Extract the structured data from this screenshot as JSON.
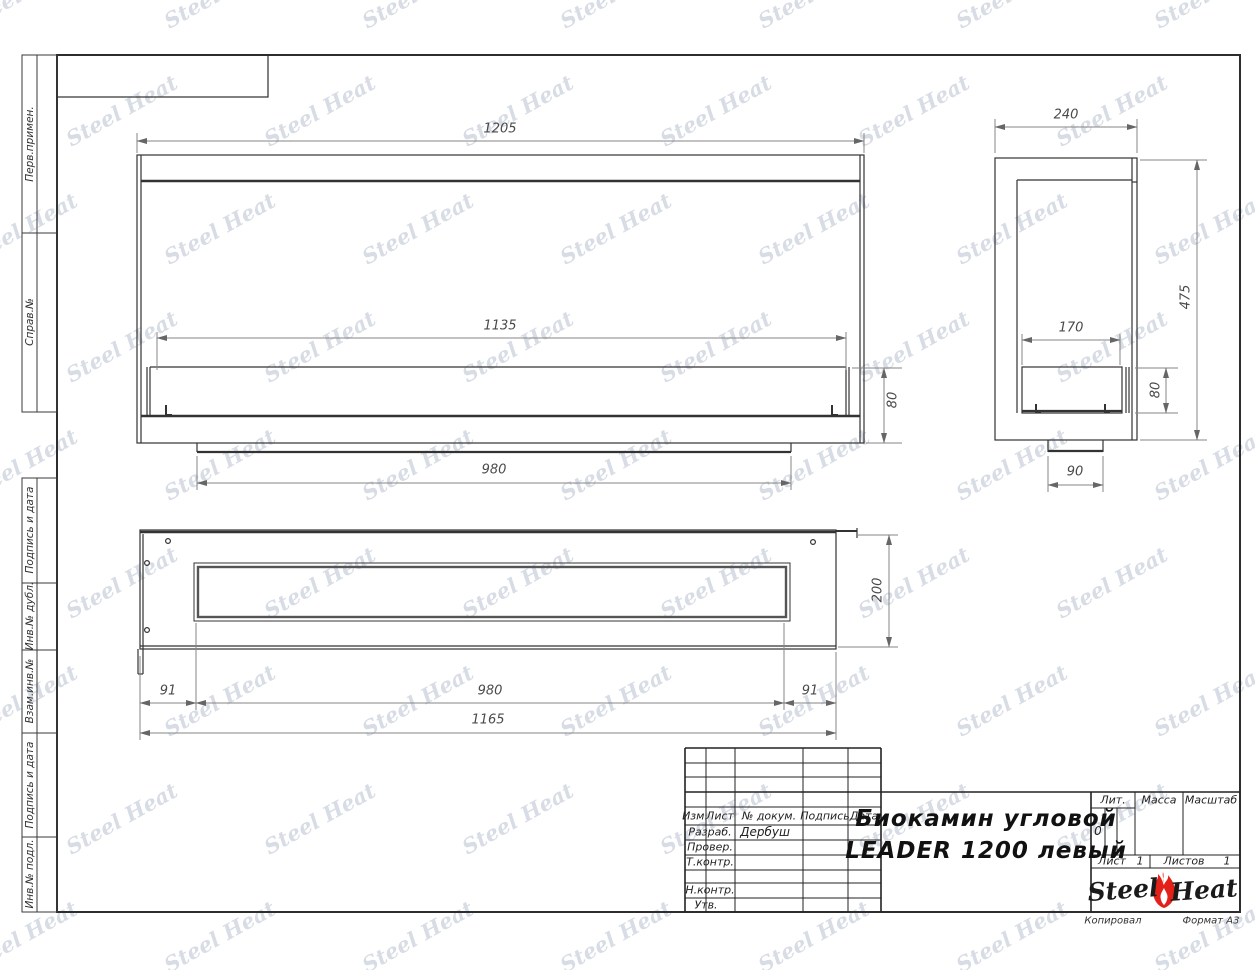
{
  "drawing_title": {
    "line1": "Биокамин угловой",
    "line2": "LEADER 1200 левый"
  },
  "frame_labels": [
    {
      "label": "Перв.примен."
    },
    {
      "label": "Справ.№"
    },
    {
      "label": "Подпись и дата"
    },
    {
      "label": "Инв.№ дубл."
    },
    {
      "label": "Взам.инв.№"
    },
    {
      "label": "Подпись и дата"
    },
    {
      "label": "Инв.№ подл."
    }
  ],
  "dims": {
    "front": {
      "total_width": "1205",
      "inner_width": "1135",
      "burner_height": "80",
      "flange_width": "980"
    },
    "side": {
      "total_depth": "240",
      "inner_depth": "170",
      "burner_height": "80",
      "total_height": "475",
      "flange_depth": "90"
    },
    "top": {
      "left_margin": "91",
      "opening_width": "980",
      "right_margin": "91",
      "total_width": "1165",
      "depth": "200"
    }
  },
  "title_block": {
    "header": {
      "izm": "Изм.",
      "list": "Лист",
      "doc": "№ докум.",
      "sign": "Подпись",
      "date": "Дата"
    },
    "rows": [
      {
        "label": "Разраб.",
        "value": "Дербуш"
      },
      {
        "label": "Провер.",
        "value": ""
      },
      {
        "label": "Т.контр.",
        "value": ""
      },
      {
        "label": "Н.контр.",
        "value": ""
      },
      {
        "label": "Утв.",
        "value": ""
      }
    ],
    "lit_label": "Лит.",
    "lit_value": "0",
    "mass_label": "Масса",
    "scale_label": "Масштаб",
    "sheet_label": "Лист",
    "sheet_number": "1",
    "sheets_label": "Листов",
    "sheets_total": "1",
    "logo_part1": "Steel",
    "logo_part2": "Heat",
    "footer_left": "Копировал",
    "footer_right": "Формат А3"
  },
  "watermark": {
    "text": "Steel Heat"
  },
  "colors": {
    "flame": "#e32119",
    "object_line": "#333333",
    "dim_line": "#848484",
    "watermark": "rgba(150,162,186,0.38)"
  }
}
